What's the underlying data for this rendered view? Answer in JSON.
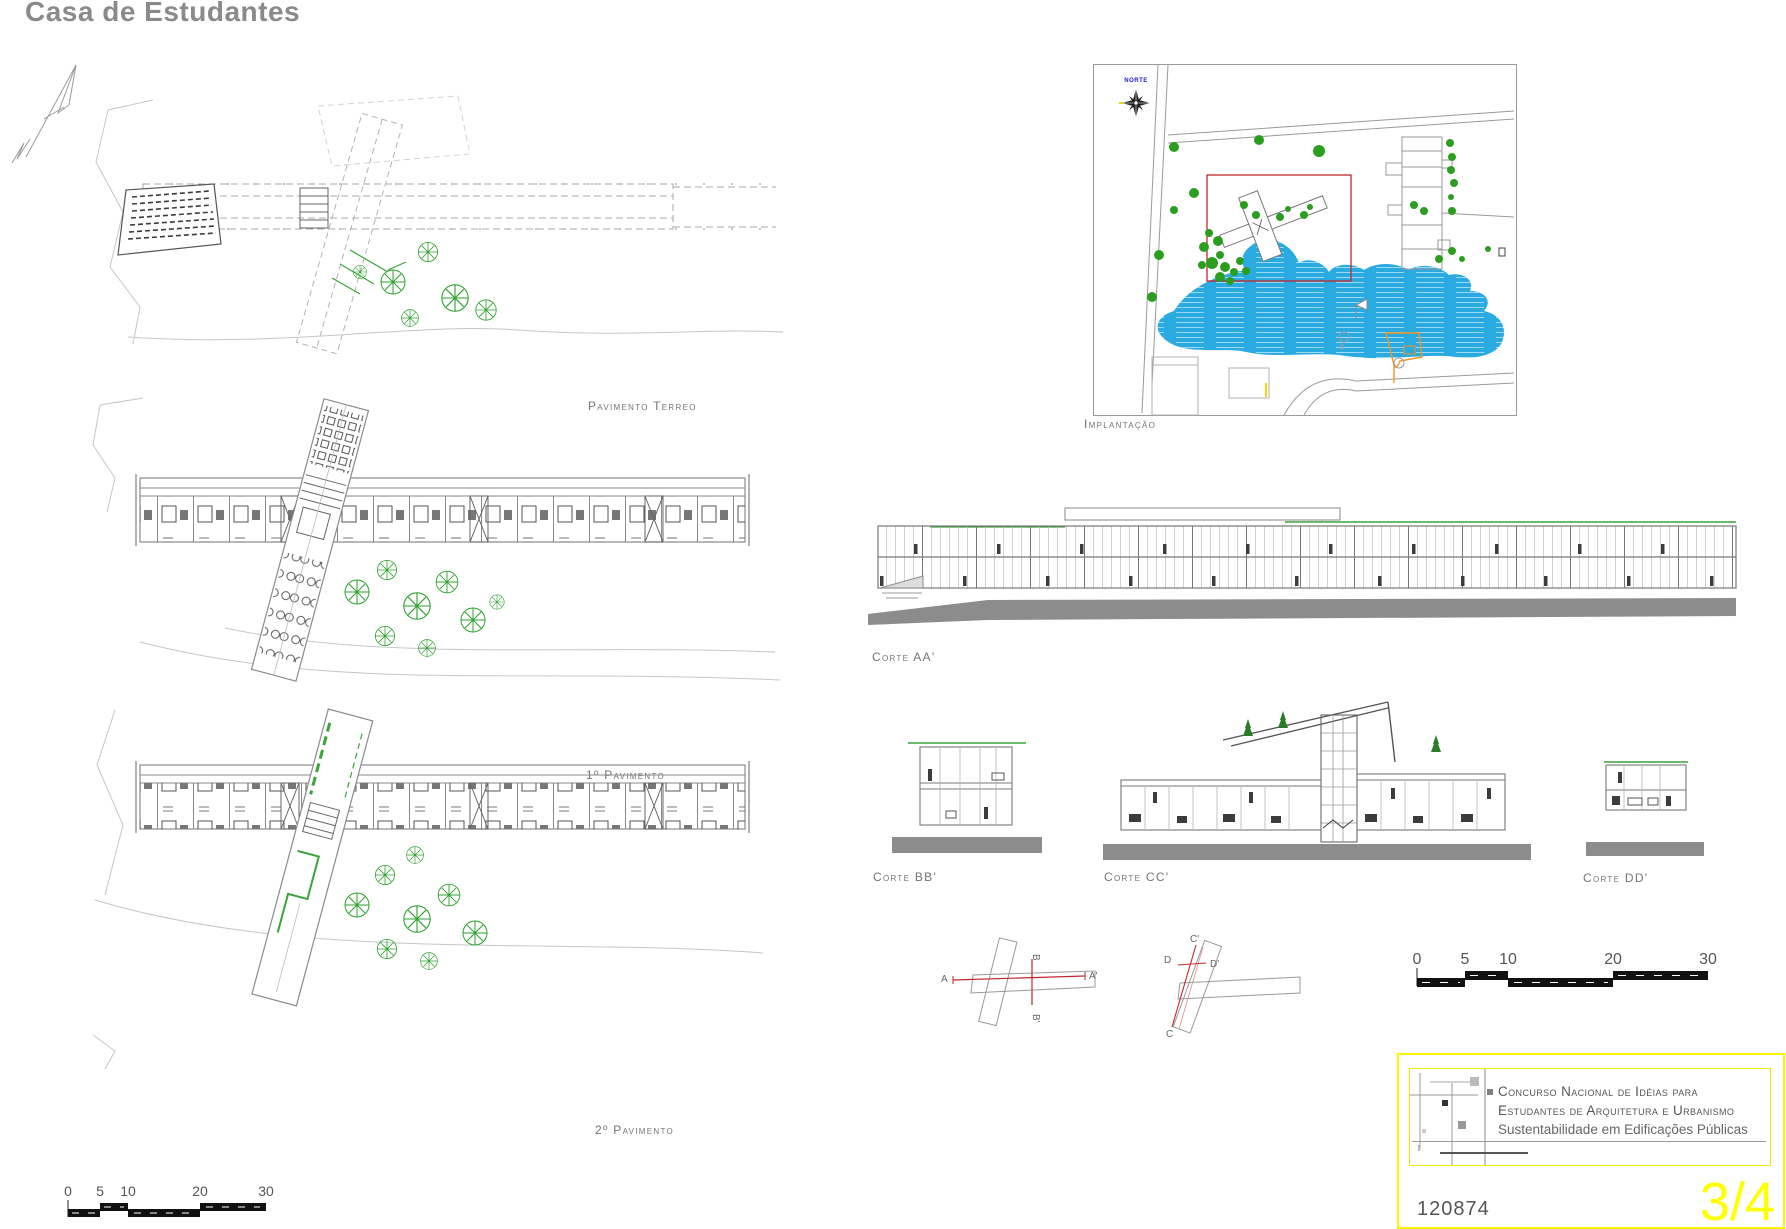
{
  "page": {
    "title": "Casa de Estudantes"
  },
  "plans": {
    "terreo": {
      "label": "Pavimento Terreo"
    },
    "primeiro": {
      "label": "1º Pavimento"
    },
    "segundo": {
      "label": "2º Pavimento"
    }
  },
  "site": {
    "label": "Implantação",
    "north": "NORTE"
  },
  "sections": {
    "aa": "Corte AA'",
    "bb": "Corte BB'",
    "cc": "Corte CC'",
    "dd": "Corte DD'"
  },
  "keyplan_ab": {
    "a": "A",
    "a_prime": "A'",
    "b": "B",
    "b_prime": "B'"
  },
  "keyplan_cd": {
    "c": "C",
    "c_prime": "C'",
    "d": "D",
    "d_prime": "D'"
  },
  "scalebar": {
    "labels": [
      "0",
      "5",
      "10",
      "20",
      "30"
    ]
  },
  "titleblock": {
    "line1": "Concurso Nacional de Idéias para",
    "line2": "Estudantes de Arquitetura e Urbanismo",
    "line3": "Sustentabilidade em Edificações Públicas",
    "entry_code": "120874",
    "sheet_number": "3/4"
  },
  "colors": {
    "accent_yellow": "#FFFF00",
    "lake_blue": "#29ABE2",
    "tree_green": "#2FA12F",
    "section_red": "#C1272D",
    "orange": "#F7931E",
    "north_blue": "#1A1ACC",
    "title_gray": "#8A8A8A"
  }
}
